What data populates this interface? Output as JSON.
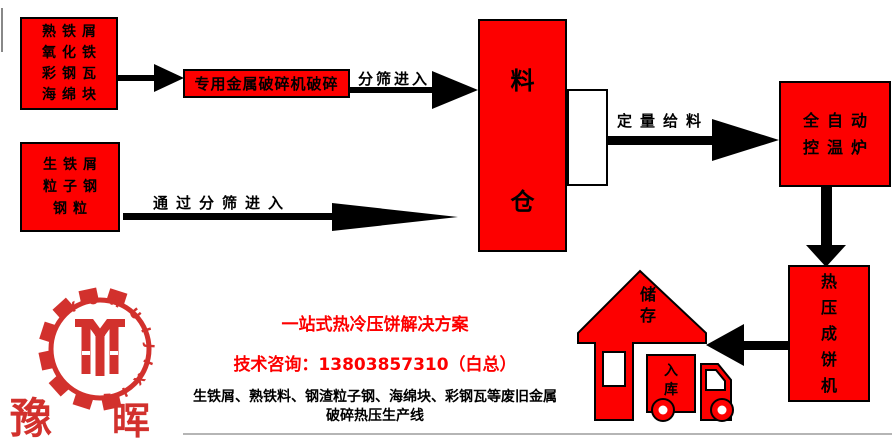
{
  "colors": {
    "box_red": "#fd0000",
    "logo_red": "#d2312d",
    "promo_red": "#fd0000",
    "black": "#000000"
  },
  "boxes": {
    "materials_top": {
      "lines": [
        "熟铁屑",
        "氧化铁",
        "彩钢瓦",
        "海绵块"
      ]
    },
    "materials_bottom": {
      "lines": [
        "生铁屑",
        "粒子钢",
        "钢粒"
      ]
    },
    "crusher": {
      "label": "专用金属破碎机破碎"
    },
    "silo": {
      "chars": [
        "料",
        "仓"
      ]
    },
    "furnace": {
      "lines": [
        "全自动",
        "控温炉"
      ]
    },
    "press": {
      "chars": [
        "热",
        "压",
        "成",
        "饼",
        "机"
      ]
    }
  },
  "arrows": {
    "sieve_label": "分筛进入",
    "through_sieve_label": "通过分筛进入",
    "feed_label": "定量给料"
  },
  "icons": {
    "storage_house": {
      "chars": [
        "储",
        "存"
      ]
    },
    "warehouse_truck": {
      "chars": [
        "入",
        "库"
      ]
    }
  },
  "logo": {
    "ring_text": "YUHUIJIXIE",
    "name_left": "豫",
    "name_right": "晖"
  },
  "promo": {
    "line1": "一站式热冷压饼解决方案",
    "line2": "技术咨询：13803857310（白总）",
    "line3": "生铁屑、熟铁料、钢渣粒子钢、海绵块、彩钢瓦等废旧金属",
    "line4": "破碎热压生产线"
  }
}
